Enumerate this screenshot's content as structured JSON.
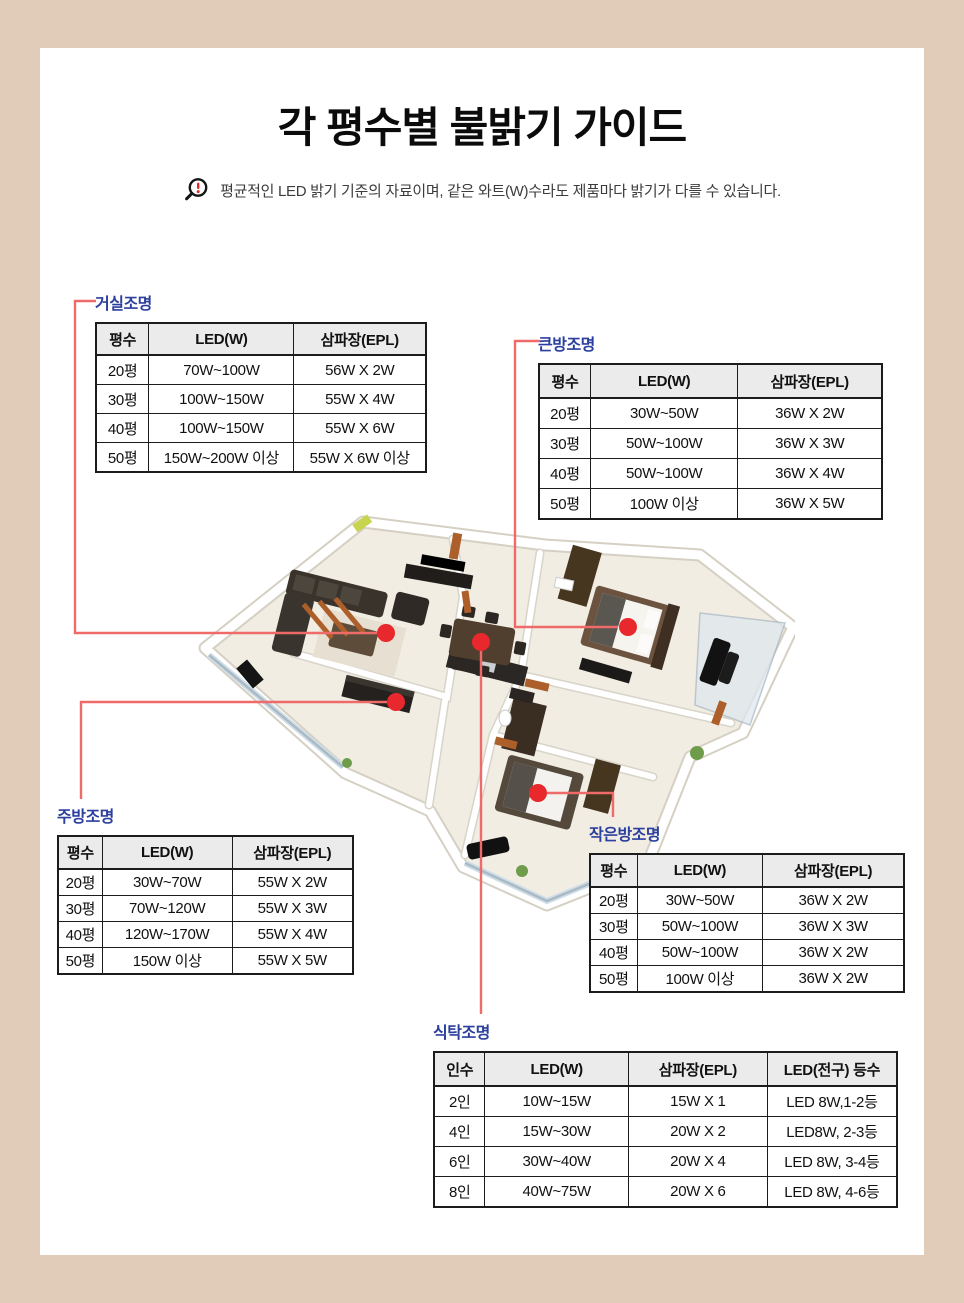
{
  "title": "각 평수별 불밝기 가이드",
  "notice": {
    "icon": "alert-magnifier-icon",
    "text": "평균적인 LED 밝기 기준의 자료이며, 같은 와트(W)수라도 제품마다 밝기가 다를 수 있습니다."
  },
  "colors": {
    "frame_beige": "#e0ccb8",
    "label_blue": "#2b3f9e",
    "dot_red": "#e8282c",
    "connector_red": "#ef6b69",
    "header_gray": "#ebebeb",
    "alert_red": "#e8262a"
  },
  "markers": {
    "living": "living-room-marker",
    "dining": "dining-table-marker",
    "big_room": "big-room-marker",
    "kitchen": "kitchen-marker",
    "small_room": "small-room-marker"
  },
  "tables": {
    "living": {
      "label": "거실조명",
      "headers": [
        "평수",
        "LED(W)",
        "삼파장(EPL)"
      ],
      "rows": [
        [
          "20평",
          "70W~100W",
          "56W X 2W"
        ],
        [
          "30평",
          "100W~150W",
          "55W X 4W"
        ],
        [
          "40평",
          "100W~150W",
          "55W X 6W"
        ],
        [
          "50평",
          "150W~200W 이상",
          "55W X 6W 이상"
        ]
      ]
    },
    "big_room": {
      "label": "큰방조명",
      "headers": [
        "평수",
        "LED(W)",
        "삼파장(EPL)"
      ],
      "rows": [
        [
          "20평",
          "30W~50W",
          "36W X 2W"
        ],
        [
          "30평",
          "50W~100W",
          "36W X 3W"
        ],
        [
          "40평",
          "50W~100W",
          "36W X 4W"
        ],
        [
          "50평",
          "100W 이상",
          "36W X 5W"
        ]
      ]
    },
    "kitchen": {
      "label": "주방조명",
      "headers": [
        "평수",
        "LED(W)",
        "삼파장(EPL)"
      ],
      "rows": [
        [
          "20평",
          "30W~70W",
          "55W X 2W"
        ],
        [
          "30평",
          "70W~120W",
          "55W X 3W"
        ],
        [
          "40평",
          "120W~170W",
          "55W X 4W"
        ],
        [
          "50평",
          "150W 이상",
          "55W X 5W"
        ]
      ]
    },
    "small_room": {
      "label": "작은방조명",
      "headers": [
        "평수",
        "LED(W)",
        "삼파장(EPL)"
      ],
      "rows": [
        [
          "20평",
          "30W~50W",
          "36W X 2W"
        ],
        [
          "30평",
          "50W~100W",
          "36W X 3W"
        ],
        [
          "40평",
          "50W~100W",
          "36W X 2W"
        ],
        [
          "50평",
          "100W 이상",
          "36W X 2W"
        ]
      ]
    },
    "dining": {
      "label": "식탁조명",
      "headers": [
        "인수",
        "LED(W)",
        "삼파장(EPL)",
        "LED(전구) 등수"
      ],
      "rows": [
        [
          "2인",
          "10W~15W",
          "15W X 1",
          "LED 8W,1-2등"
        ],
        [
          "4인",
          "15W~30W",
          "20W X 2",
          "LED8W, 2-3등"
        ],
        [
          "6인",
          "30W~40W",
          "20W X 4",
          "LED 8W, 3-4등"
        ],
        [
          "8인",
          "40W~75W",
          "20W X 6",
          "LED 8W, 4-6등"
        ]
      ]
    }
  }
}
